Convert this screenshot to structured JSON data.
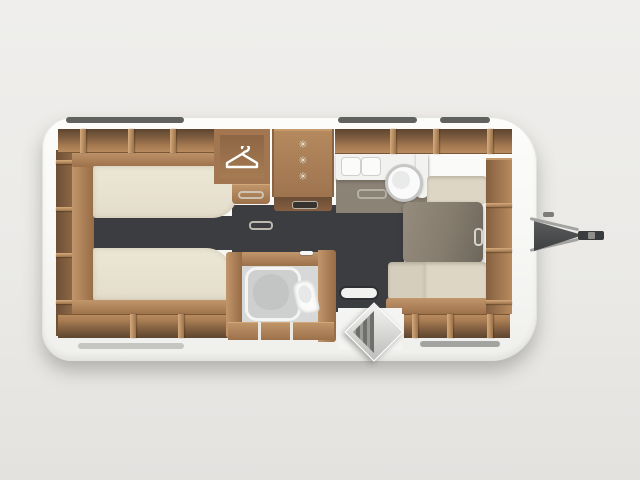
{
  "scene": {
    "description": "Top-view floor plan of a single-axle travel caravan",
    "background_color": "#ebeae7"
  },
  "caravan": {
    "body_color": "#f8f8f6",
    "floor_carpet_color": "#3b3d40",
    "wood_color": "#b2845a",
    "areas": {
      "bedroom": {
        "name": "twin single beds",
        "mattress_color": "#eae4d4"
      },
      "wardrobe": {
        "name": "wardrobe",
        "icon": "hanger-icon"
      },
      "fridge": {
        "name": "refrigerator",
        "stars": [
          "✳",
          "✳",
          "✳"
        ]
      },
      "kitchen": {
        "name": "kitchen",
        "fixtures": [
          "hob",
          "sink"
        ]
      },
      "bathroom": {
        "name": "bathroom",
        "fixtures": [
          "shower",
          "toilet",
          "faucet"
        ]
      },
      "dinette": {
        "name": "U-shaped dinette",
        "table_color": "#837b6d",
        "cushion_color": "#ddd6c5"
      },
      "entry": {
        "name": "entrance door, open"
      },
      "hitch": {
        "name": "tow hitch drawbar"
      }
    }
  }
}
